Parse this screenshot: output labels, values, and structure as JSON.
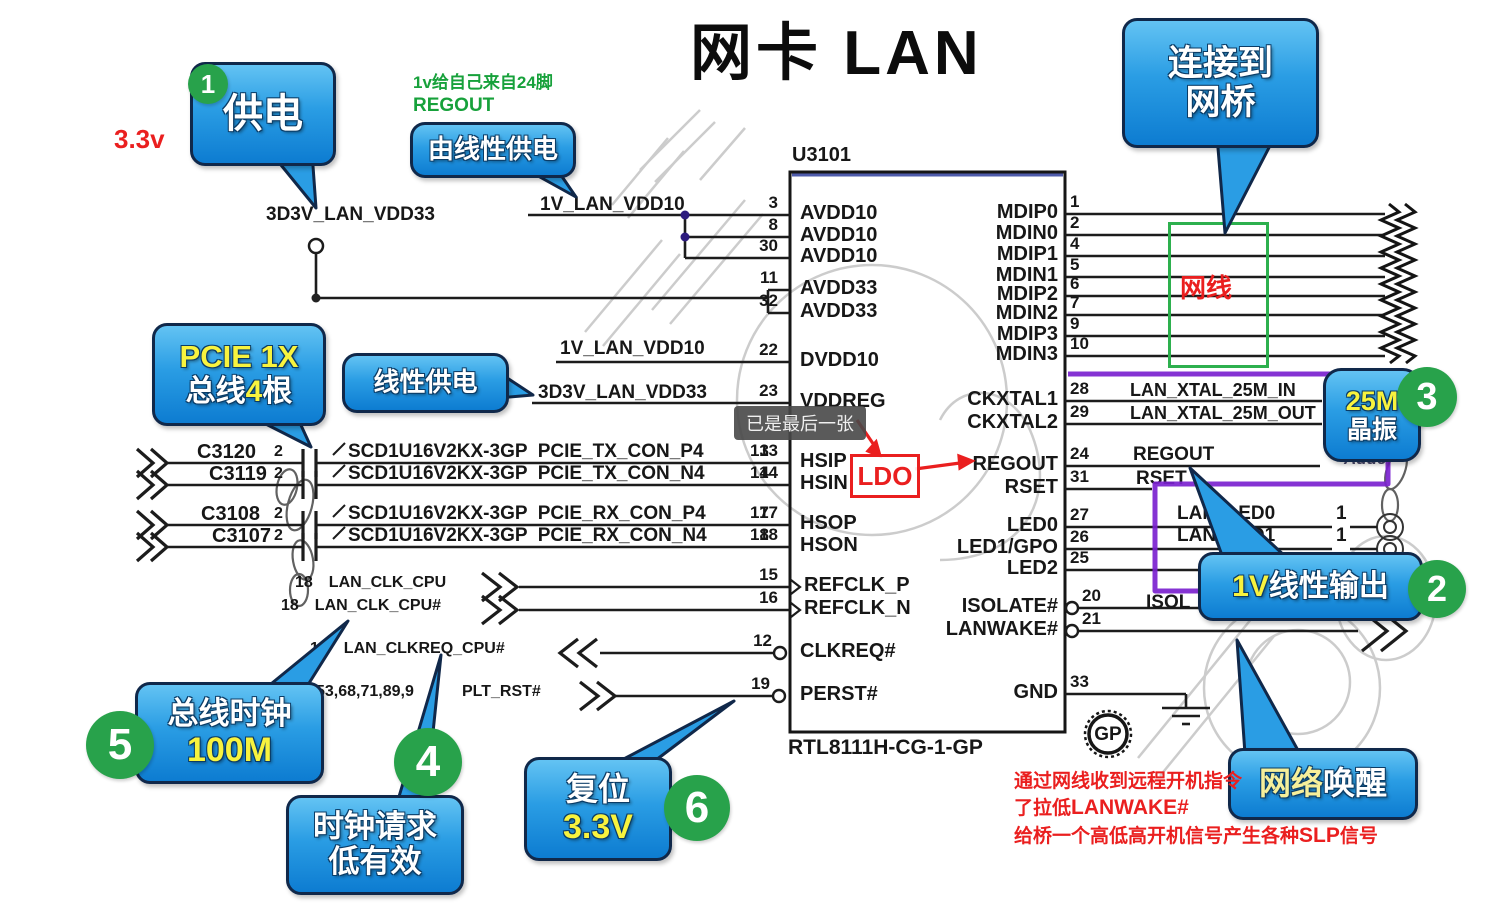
{
  "title": "网卡 LAN",
  "chip": {
    "refdes": "U3101",
    "part": "RTL8111H-CG-1-GP",
    "logo": "GP",
    "left_pins": [
      {
        "num": "3",
        "name": "AVDD10"
      },
      {
        "num": "8",
        "name": "AVDD10"
      },
      {
        "num": "30",
        "name": "AVDD10"
      },
      {
        "num": "11",
        "name": "AVDD33"
      },
      {
        "num": "32",
        "name": "AVDD33"
      },
      {
        "num": "22",
        "name": "DVDD10"
      },
      {
        "num": "23",
        "name": "VDDREG"
      },
      {
        "num": "13",
        "name": "HSIP"
      },
      {
        "num": "14",
        "name": "HSIN"
      },
      {
        "num": "17",
        "name": "HSOP"
      },
      {
        "num": "18",
        "name": "HSON"
      },
      {
        "num": "15",
        "name": "REFCLK_P"
      },
      {
        "num": "16",
        "name": "REFCLK_N"
      },
      {
        "num": "12",
        "name": "CLKREQ#"
      },
      {
        "num": "19",
        "name": "PERST#"
      }
    ],
    "right_pins": [
      {
        "num": "1",
        "name": "MDIP0"
      },
      {
        "num": "2",
        "name": "MDIN0"
      },
      {
        "num": "4",
        "name": "MDIP1"
      },
      {
        "num": "5",
        "name": "MDIN1"
      },
      {
        "num": "6",
        "name": "MDIP2"
      },
      {
        "num": "7",
        "name": "MDIN2"
      },
      {
        "num": "9",
        "name": "MDIP3"
      },
      {
        "num": "10",
        "name": "MDIN3"
      },
      {
        "num": "28",
        "name": "CKXTAL1"
      },
      {
        "num": "29",
        "name": "CKXTAL2"
      },
      {
        "num": "24",
        "name": "REGOUT"
      },
      {
        "num": "31",
        "name": "RSET"
      },
      {
        "num": "27",
        "name": "LED0"
      },
      {
        "num": "26",
        "name": "LED1/GPO"
      },
      {
        "num": "25",
        "name": "LED2"
      },
      {
        "num": "20",
        "name": "ISOLATE#"
      },
      {
        "num": "21",
        "name": "LANWAKE#"
      },
      {
        "num": "33",
        "name": "GND"
      }
    ]
  },
  "nets": {
    "vdd10_a": "1V_LAN_VDD10",
    "vdd33_a": "3D3V_LAN_VDD33",
    "vdd10_b": "1V_LAN_VDD10",
    "vdd33_b": "3D3V_LAN_VDD33",
    "xtal_in": "LAN_XTAL_25M_IN",
    "xtal_out": "LAN_XTAL_25M_OUT",
    "regout": "REGOUT",
    "rset": "RSET",
    "led0": "LAN_LED0",
    "led1": "LAN_LED1",
    "led_pin": "1",
    "isolate": "ISOL"
  },
  "pcie": [
    {
      "cap": "C3120",
      "cap_pin": "2",
      "label": "SCD1U16V2KX-3GP  PCIE_TX_CON_P4",
      "pin": "13"
    },
    {
      "cap": "C3119",
      "cap_pin": "2",
      "label": "SCD1U16V2KX-3GP  PCIE_TX_CON_N4",
      "pin": "14"
    },
    {
      "cap": "C3108",
      "cap_pin": "2",
      "label": "SCD1U16V2KX-3GP  PCIE_RX_CON_P4",
      "pin": "17"
    },
    {
      "cap": "C3107",
      "cap_pin": "2",
      "label": "SCD1U16V2KX-3GP  PCIE_RX_CON_N4",
      "pin": "18"
    }
  ],
  "clocks": [
    {
      "sheet": "18",
      "label": "LAN_CLK_CPU"
    },
    {
      "sheet": "18",
      "label": "LAN_CLK_CPU#"
    },
    {
      "sheet": "18",
      "label": "LAN_CLKREQ_CPU#"
    },
    {
      "sheet": "53,68,71,89,9",
      "label": "PLT_RST#"
    }
  ],
  "bubbles": {
    "power": "供电",
    "by_linear": "由线性供电",
    "bridge_l1": "连接到",
    "bridge_l2": "网桥",
    "pcie_l1": "PCIE 1X",
    "pcie_l2a": "总线",
    "pcie_l2b": "4",
    "pcie_l2c": "根",
    "linear": "线性供电",
    "xtal_l1": "25M",
    "xtal_l2": "晶振",
    "out1v_a": "1V",
    "out1v_b": "线性输出",
    "wol_a": "网络",
    "wol_b": "唤醒",
    "busclk_l1": "总线时钟",
    "busclk_l2": "100M",
    "clkreq_l1": "时钟请求",
    "clkreq_l2": "低有效",
    "reset_l1": "复位",
    "reset_l2": "3.3V"
  },
  "badges": {
    "s1": "1",
    "s2": "2",
    "s3": "3",
    "s4": "4",
    "s5": "5",
    "s6": "6"
  },
  "annotations": {
    "voltage": "3.3v",
    "green_l1": "1v给自己来自24脚",
    "green_l2": "REGOUT",
    "cable": "网线",
    "ldo": "LDO",
    "tooltip": "已是最后一张",
    "watermark": "Adde",
    "wake_l1": "通过网线收到远程开机指令",
    "wake_l2a": "了拉低",
    "wake_l2b": "LANWAKE#",
    "wake_l3a": "给桥一个高低高开机信号产生各种",
    "wake_l3b": "SLP",
    "wake_l3c": "信号"
  }
}
